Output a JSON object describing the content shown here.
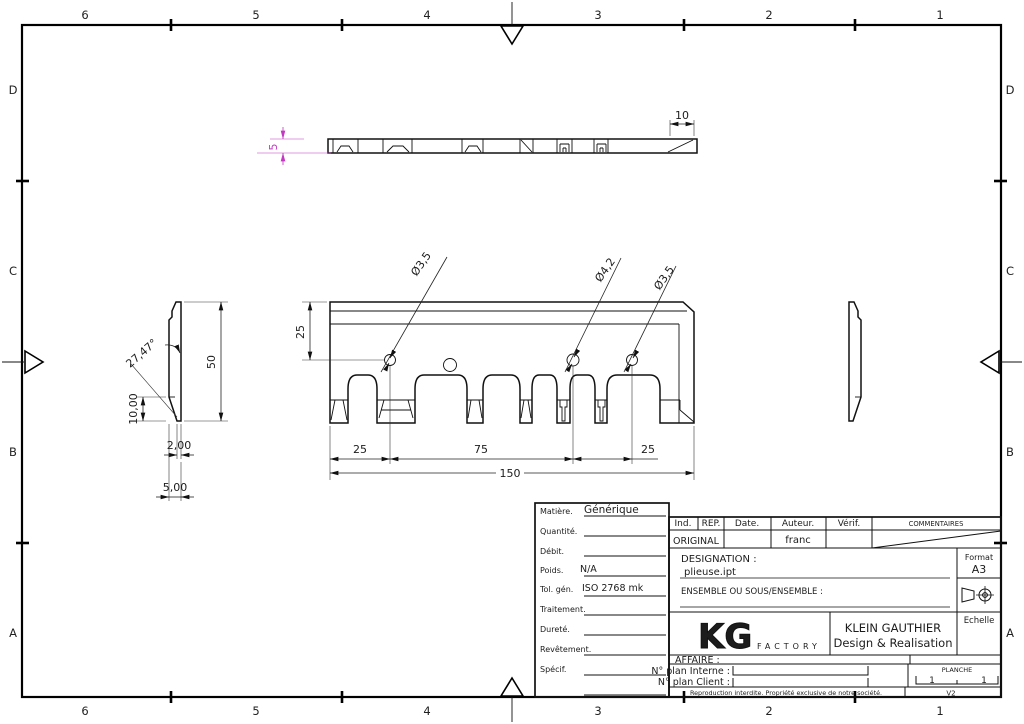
{
  "sheet": {
    "columns": [
      "6",
      "5",
      "4",
      "3",
      "2",
      "1"
    ],
    "rows": [
      "D",
      "C",
      "B",
      "A"
    ]
  },
  "colors": {
    "line": "#111111",
    "highlight_dim": "#c238c2"
  },
  "views": {
    "top_view": {
      "dims": {
        "thickness": "5",
        "chamfer_length": "10"
      }
    },
    "front_view": {
      "dims": {
        "hole1_dia": "Ø3,5",
        "hole2_dia": "Ø4,2",
        "hole3_dia": "Ø3,5",
        "hole_line_offset": "25",
        "span_left": "25",
        "span_mid": "75",
        "span_right": "25",
        "total_length": "150"
      }
    },
    "side_view": {
      "dims": {
        "angle": "27,47°",
        "height": "50",
        "foot_height": "10,00",
        "tip_width": "2,00",
        "width": "5,00"
      }
    }
  },
  "title_block": {
    "material_table": {
      "rows": [
        {
          "label": "Matière.",
          "value": "Générique"
        },
        {
          "label": "Quantité.",
          "value": ""
        },
        {
          "label": "Débit.",
          "value": ""
        },
        {
          "label": "Poids.",
          "value": "N/A"
        },
        {
          "label": "Tol. gén.",
          "value": "ISO 2768 mk"
        },
        {
          "label": "Traitement.",
          "value": ""
        },
        {
          "label": "Dureté.",
          "value": ""
        },
        {
          "label": "Revêtement.",
          "value": ""
        },
        {
          "label": "Spécif.",
          "value": ""
        }
      ]
    },
    "revision": {
      "headers": [
        "Ind.",
        "REP.",
        "Date.",
        "Auteur.",
        "Vérif."
      ],
      "comments_header": "COMMENTAIRES",
      "row": {
        "ind": "ORIGINAL",
        "author": "franc"
      }
    },
    "designation": {
      "label": "DESIGNATION :",
      "value": "plieuse.ipt",
      "ensemble_label": "ENSEMBLE OU SOUS/ENSEMBLE :"
    },
    "format": {
      "label": "Format",
      "value": "A3"
    },
    "scale_label": "Echelle",
    "company": {
      "logo": "KG",
      "logo_sub": "FACTORY",
      "name": "KLEIN GAUTHIER",
      "tagline": "Design & Realisation"
    },
    "affaire_label": "AFFAIRE :",
    "plan_interne_label": "N° plan Interne :",
    "plan_client_label": "N° plan Client :",
    "planche": {
      "label": "PLANCHE",
      "sheet_no": "1",
      "sheet_of": "1",
      "version": "V2"
    },
    "footer": "Reproduction interdite. Propriété exclusive de notre société."
  }
}
